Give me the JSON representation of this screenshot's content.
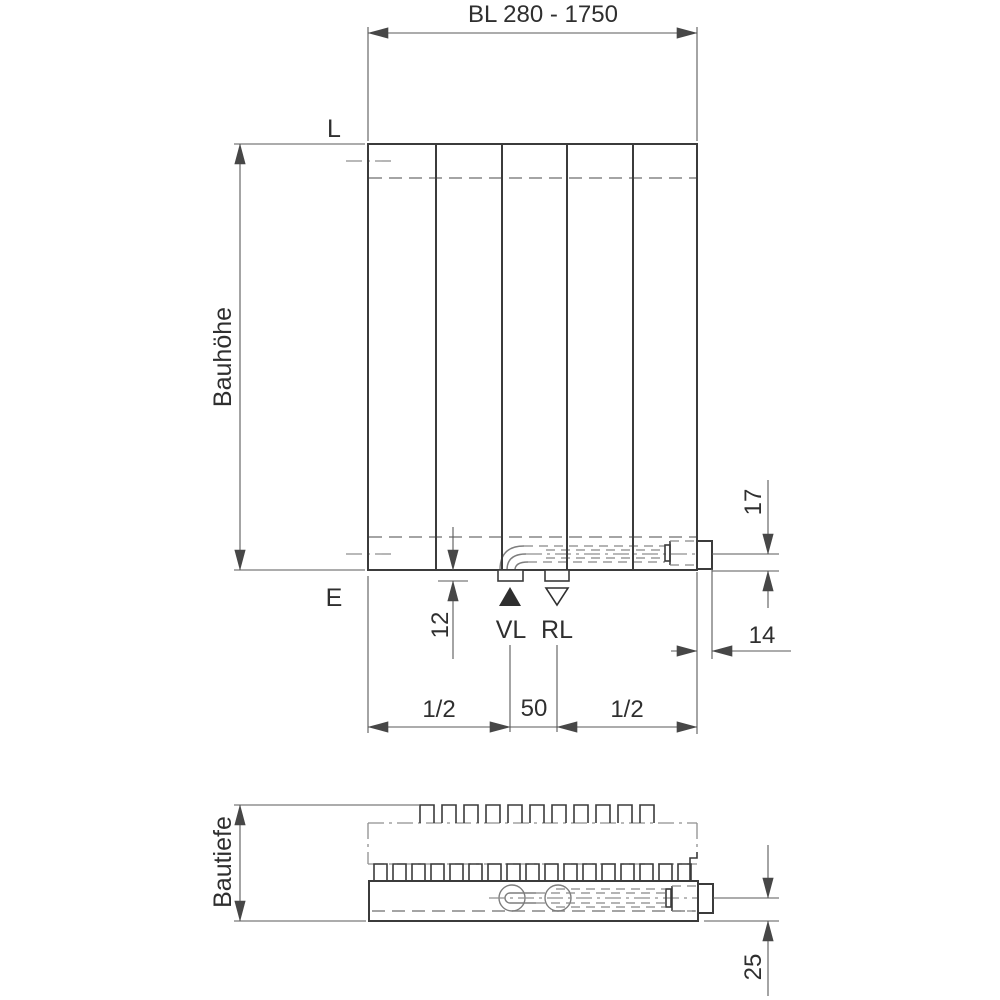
{
  "drawing": {
    "title_dim": "BL 280 - 1750",
    "height_label": "Bauhöhe",
    "depth_label": "Bautiefe",
    "top_level_label": "L",
    "bottom_level_label": "E",
    "supply_label": "VL",
    "return_label": "RL",
    "dims": {
      "pipe_center_to_bottom": "17",
      "nut_projection": "14",
      "tab_projection": "12",
      "pipe_depth_offset": "25",
      "half_left": "1/2",
      "center_spacing": "50",
      "half_right": "1/2"
    }
  },
  "colors": {
    "outline": "#3b3b3b",
    "dimension": "#5a5a5a",
    "hidden_line": "#868686",
    "centerline": "#8f8f8f",
    "text": "#2f2f2f",
    "background": "#ffffff"
  }
}
